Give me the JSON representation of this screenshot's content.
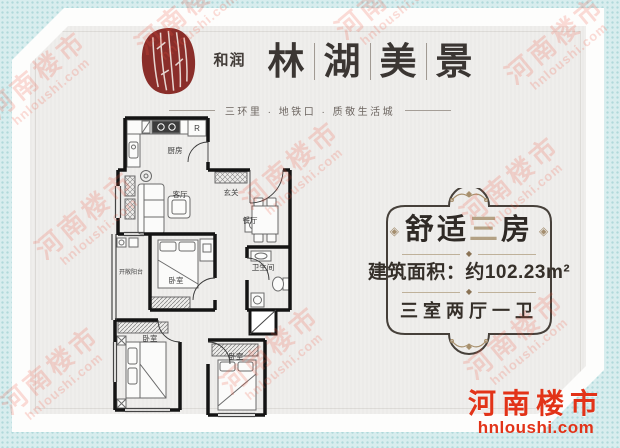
{
  "brand": {
    "name_side": "和润",
    "name_chars": [
      "林",
      "湖",
      "美",
      "景"
    ],
    "tagline": "三环里 · 地铁口 · 质敬生活城",
    "seal_color": "#8a2e2a"
  },
  "floorplan": {
    "rooms": {
      "kitchen": "厨房",
      "entry": "玄关",
      "living": "客厅",
      "dining": "餐厅",
      "bathroom": "卫生间",
      "balcony": "开敞阳台",
      "bedroom": "卧室",
      "fridge_label": "R"
    }
  },
  "info_panel": {
    "title": {
      "prefix": "舒适",
      "highlight": "三",
      "suffix": "房"
    },
    "ornament_diamond": "◈",
    "divider_diamond": "◆",
    "area_text": "建筑面积：约102.23m²",
    "layout_text": "三室两厅一卫",
    "frame_color": "#46403a",
    "accent_tan": "#a8906d"
  },
  "watermark": {
    "name": "河南楼市",
    "url": "hnloushi.com",
    "color": "#f0543e"
  },
  "footer_logo": {
    "name": "河南楼市",
    "url": "hnloushi.com",
    "color": "#e23318"
  }
}
